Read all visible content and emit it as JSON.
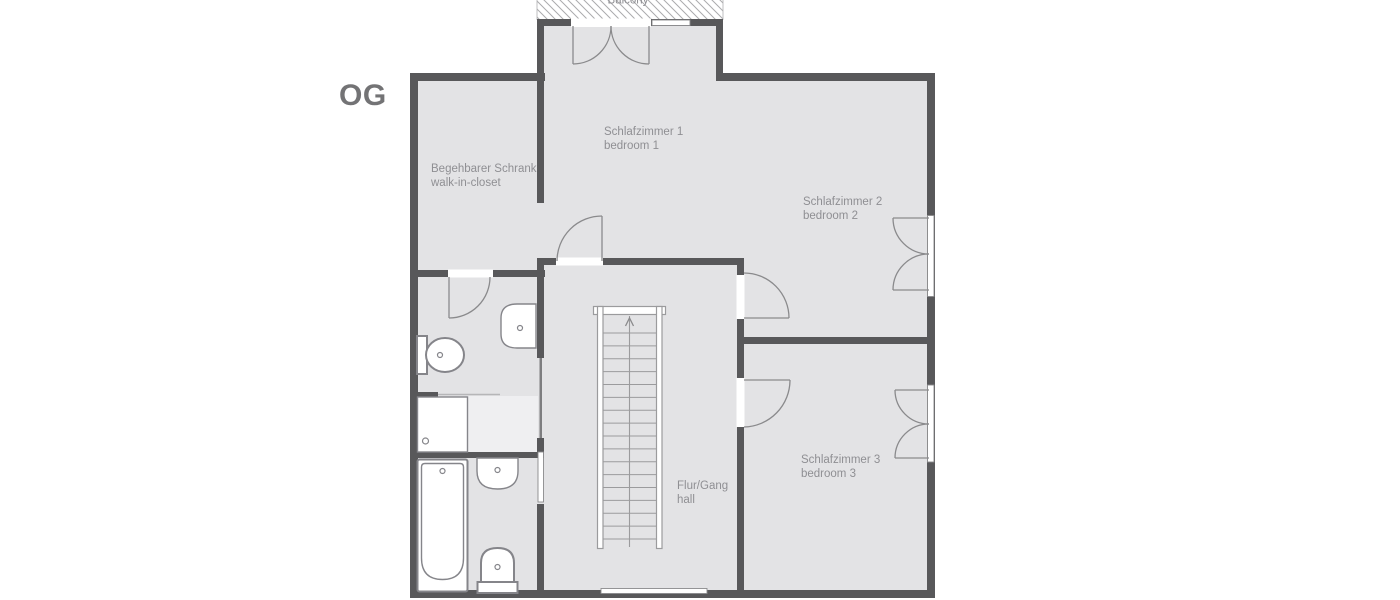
{
  "floor_label": "OG",
  "balcony": {
    "label": "Balcony"
  },
  "rooms": {
    "bedroom1": {
      "name_de": "Schlafzimmer 1",
      "name_en": "bedroom 1"
    },
    "closet": {
      "name_de": "Begehbarer Schrank",
      "name_en": "walk-in-closet"
    },
    "bedroom2": {
      "name_de": "Schlafzimmer 2",
      "name_en": "bedroom 2"
    },
    "bedroom3": {
      "name_de": "Schlafzimmer 3",
      "name_en": "bedroom 3"
    },
    "hall": {
      "name_de": "Flur/Gang",
      "name_en": "hall"
    }
  },
  "colors": {
    "wall": "#58585a",
    "floor": "#e3e3e5",
    "floor_light": "#efeff1",
    "fixture_stroke": "#85858a",
    "door_stroke": "#8a8a8c",
    "stair_stroke": "#9b9b9d",
    "text": "#8f8f93",
    "title_text": "#737375",
    "hatch": "#ababad",
    "white": "#ffffff"
  }
}
